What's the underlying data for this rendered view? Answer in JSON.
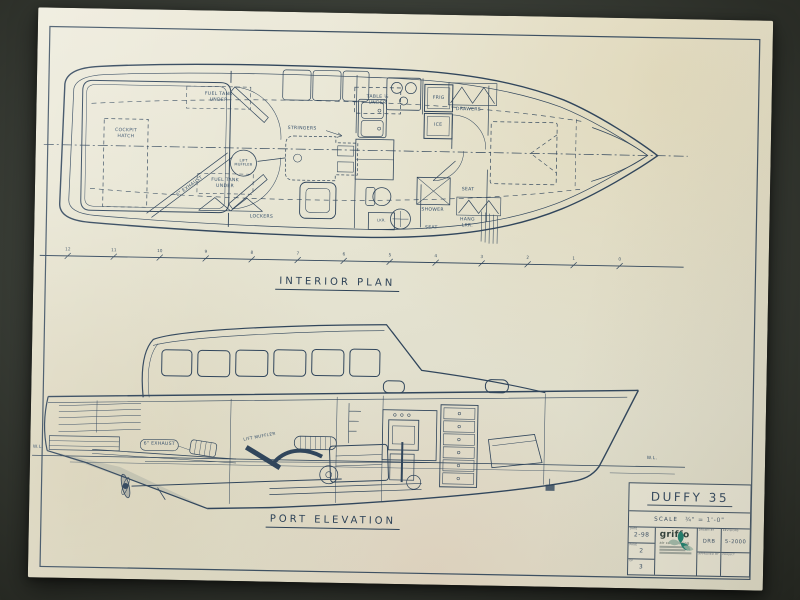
{
  "colors": {
    "ink": "#31465c",
    "paper": "#e7e5d3",
    "background": "#3b3f38",
    "logo_teal": "#1f7e6c"
  },
  "interior_plan": {
    "title": "INTERIOR PLAN",
    "labels": {
      "cockpit_hatch": "COCKPIT HATCH",
      "exhaust": "6\" EXHAUST",
      "fuel_tank_stbd": "FUEL TANK UNDER",
      "fuel_tank_port": "FUEL TANK UNDER",
      "table": "TABLE ½ UNDER",
      "stringers": "STRINGERS",
      "lift_muffler": "LIFT MUFFLER",
      "lockers": "LOCKERS",
      "frig": "FRIG",
      "ice": "ICE",
      "drawers": "DRAWERS",
      "shower": "SHOWER",
      "seat_fwd": "SEAT",
      "seat_aft": "SEAT",
      "hang_locker": "HANG LKR.",
      "locker": "LKR."
    },
    "stations": [
      "12",
      "11",
      "10",
      "9",
      "8",
      "7",
      "6",
      "5",
      "4",
      "3",
      "2",
      "1",
      "0"
    ]
  },
  "port_elevation": {
    "title": "PORT ELEVATION",
    "labels": {
      "waterline_left": "W.L.",
      "waterline_right": "W.L.",
      "exhaust": "6\" EXHAUST",
      "lift_muffler": "LIFT MUFFLER"
    }
  },
  "title_block": {
    "boat_name": "DUFFY 35",
    "scale_label": "SCALE",
    "scale_value": "¾\" = 1'-0\"",
    "date_label": "DATE",
    "date_value": "2-98",
    "page_label": "PAGE",
    "page_value": "2",
    "of_label": "OF",
    "pages_total": "3",
    "drawn_by_label": "DRAWN BY",
    "drawn_by_value": "DRB",
    "revisions_label": "REVISIONS",
    "revisions_value": "5-2000",
    "approved_label": "APPROVED BY",
    "project_label": "PROJECT",
    "company_name": "griffo",
    "company_tagline": "air conditioning"
  }
}
